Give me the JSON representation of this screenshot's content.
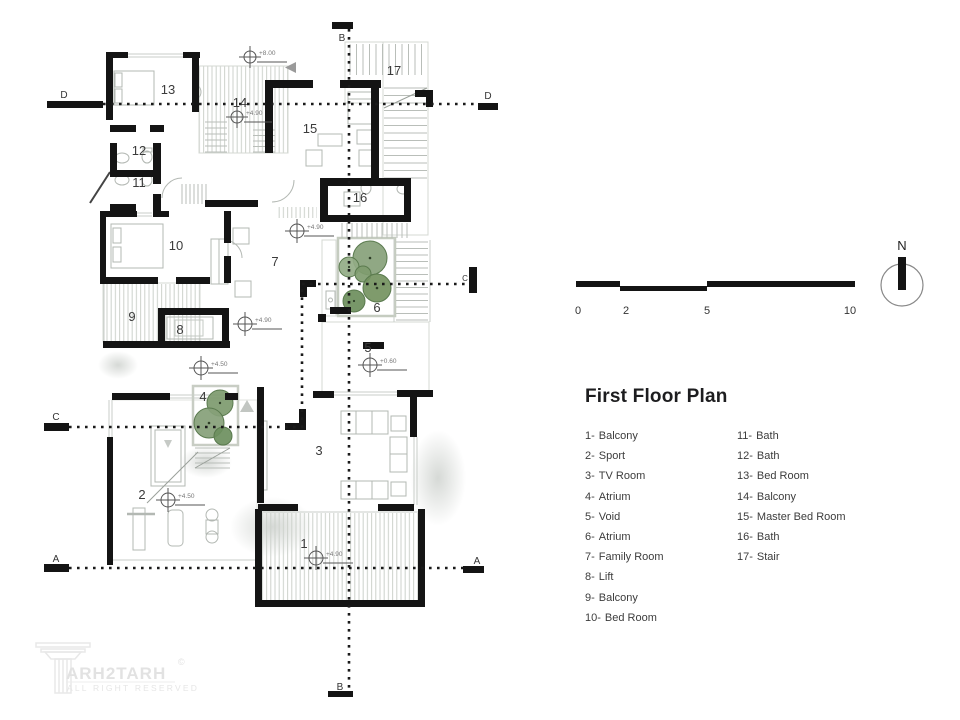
{
  "title": "First Floor Plan",
  "legend": {
    "col1": [
      {
        "num": "1-",
        "label": "Balcony"
      },
      {
        "num": "2-",
        "label": "Sport"
      },
      {
        "num": "3-",
        "label": "TV Room"
      },
      {
        "num": "4-",
        "label": "Atrium"
      },
      {
        "num": "5-",
        "label": "Void"
      },
      {
        "num": "6-",
        "label": "Atrium"
      },
      {
        "num": "7-",
        "label": "Family Room"
      },
      {
        "num": "8-",
        "label": "Lift"
      },
      {
        "num": "9-",
        "label": "Balcony"
      },
      {
        "num": "10-",
        "label": "Bed Room"
      }
    ],
    "col2": [
      {
        "num": "11-",
        "label": "Bath"
      },
      {
        "num": "12-",
        "label": "Bath"
      },
      {
        "num": "13-",
        "label": "Bed Room"
      },
      {
        "num": "14-",
        "label": "Balcony"
      },
      {
        "num": "15-",
        "label": "Master Bed Room"
      },
      {
        "num": "16-",
        "label": "Bath"
      },
      {
        "num": "17-",
        "label": "Stair"
      }
    ]
  },
  "scale_bar": {
    "ticks": [
      "0",
      "2",
      "5",
      "10"
    ]
  },
  "north": {
    "label": "N"
  },
  "logo": {
    "text": "ARH2TARH",
    "copyright": "©",
    "subtitle": "ALL RIGHT RESERVED"
  },
  "plan": {
    "rooms": [
      {
        "number": "1"
      },
      {
        "number": "2"
      },
      {
        "number": "3"
      },
      {
        "number": "4"
      },
      {
        "number": "5"
      },
      {
        "number": "6"
      },
      {
        "number": "7"
      },
      {
        "number": "8"
      },
      {
        "number": "9"
      },
      {
        "number": "10"
      },
      {
        "number": "11"
      },
      {
        "number": "12"
      },
      {
        "number": "13"
      },
      {
        "number": "14"
      },
      {
        "number": "15"
      },
      {
        "number": "16"
      },
      {
        "number": "17"
      }
    ],
    "sections": {
      "a": "A",
      "b": "B",
      "c": "C",
      "d": "D"
    },
    "elevations": [
      {
        "value": "+8.00"
      },
      {
        "value": "+4.90"
      },
      {
        "value": "+4.90"
      },
      {
        "value": "+4.90"
      },
      {
        "value": "+4.50"
      },
      {
        "value": "+0.60"
      },
      {
        "value": "+4.50"
      },
      {
        "value": "+4.90"
      }
    ],
    "colors": {
      "wall": "#141414",
      "tree_green": "#7d9a6e",
      "hatch_line": "#ccd1cb"
    }
  }
}
